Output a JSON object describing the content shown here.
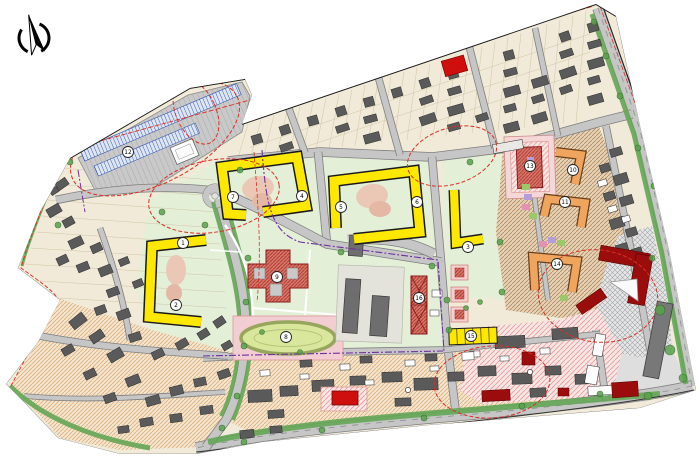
{
  "meta": {
    "description": "Urban district detailed planning drawing (site master plan) with planned perimeter residential blocks, existing housing, school, kindergarten and sports field"
  },
  "palette": {
    "background": "#ffffff",
    "site_base": "#f1ead8",
    "green_area": "#e4efd8",
    "road_fill": "#c6c6c6",
    "road_edge": "#7f7f7f",
    "green_strip": "#63a554",
    "existing_building": "#5a5a5a",
    "planned_yellow": "#ffe800",
    "planned_orange": "#f0a55f",
    "public_red_hatch": "#d4776b",
    "bright_red": "#cf0e0e",
    "dark_red": "#9b0d0d",
    "parking_blue": "#3a5cb0",
    "boundary_red": "#d93025",
    "utility_purple": "#7030a0",
    "pink_ground": "#f5d7d7",
    "tree_green": "#5aa24c"
  },
  "north_arrow": {
    "icon": "compass-north-arrow"
  },
  "markers": [
    {
      "label": "12",
      "x": 128,
      "y": 152
    },
    {
      "label": "7",
      "x": 233,
      "y": 197
    },
    {
      "label": "4",
      "x": 302,
      "y": 196
    },
    {
      "label": "5",
      "x": 341,
      "y": 207
    },
    {
      "label": "6",
      "x": 417,
      "y": 202
    },
    {
      "label": "1",
      "x": 183,
      "y": 243
    },
    {
      "label": "2",
      "x": 176,
      "y": 305
    },
    {
      "label": "3",
      "x": 468,
      "y": 247
    },
    {
      "label": "9",
      "x": 277,
      "y": 277
    },
    {
      "label": "8",
      "x": 286,
      "y": 337
    },
    {
      "label": "13",
      "x": 530,
      "y": 166
    },
    {
      "label": "10",
      "x": 573,
      "y": 170
    },
    {
      "label": "11",
      "x": 565,
      "y": 202
    },
    {
      "label": "14",
      "x": 557,
      "y": 264
    },
    {
      "label": "15",
      "x": 471,
      "y": 336
    },
    {
      "label": "16",
      "x": 419,
      "y": 298
    }
  ]
}
